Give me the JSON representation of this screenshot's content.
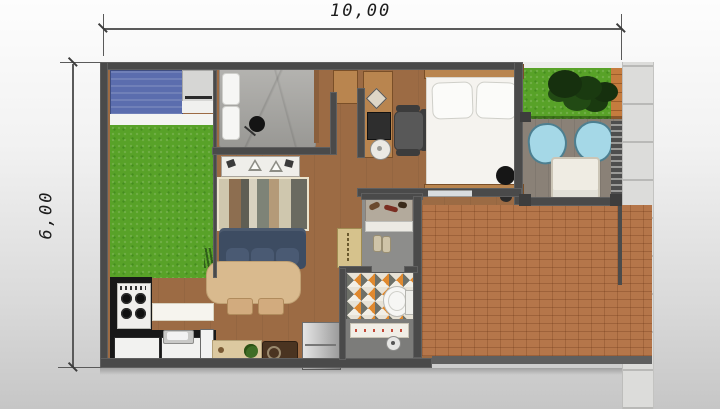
{
  "annotations": {
    "width_dimension": "10,00",
    "height_dimension": "6,00"
  },
  "colors": {
    "background_top": "#fdfdfd",
    "background_bottom": "#c6c6c6",
    "wall": "#4a4a4a",
    "wood_floor": "#9c6b44",
    "grass": "#58a228",
    "brick_paving": "#b5764a",
    "deck": "#8a8177",
    "sidewalk": "#dcdcda",
    "laundry_tank_blue": "#5b6dae",
    "sofa_navy": "#3d4c62",
    "patio_chair_blue": "#a5d8e7",
    "dining_table_tan": "#d9ba8e",
    "kitchen_counter_black": "#181818",
    "bathroom_tile_accent": "#e0892e",
    "bed1_duvet_gray": "#a6a5a1",
    "bed2_mattress_white": "#f5f3ef"
  },
  "icons": [
    "laundry-tank",
    "washing-machine",
    "bed",
    "pillow",
    "pendant-lamp",
    "tv-sideboard",
    "striped-rug",
    "sofa",
    "dining-table",
    "dining-chair",
    "stove",
    "kitchen-sink",
    "kitchen-island",
    "refrigerator",
    "entry-mat",
    "potted-plant",
    "speaker-bench",
    "shoe-rack",
    "slippers",
    "welcome-mat",
    "toilet",
    "shower-drain",
    "desk",
    "office-chair",
    "stool",
    "floor-lamp",
    "garden-tree",
    "patio-chair",
    "patio-table",
    "gate"
  ]
}
